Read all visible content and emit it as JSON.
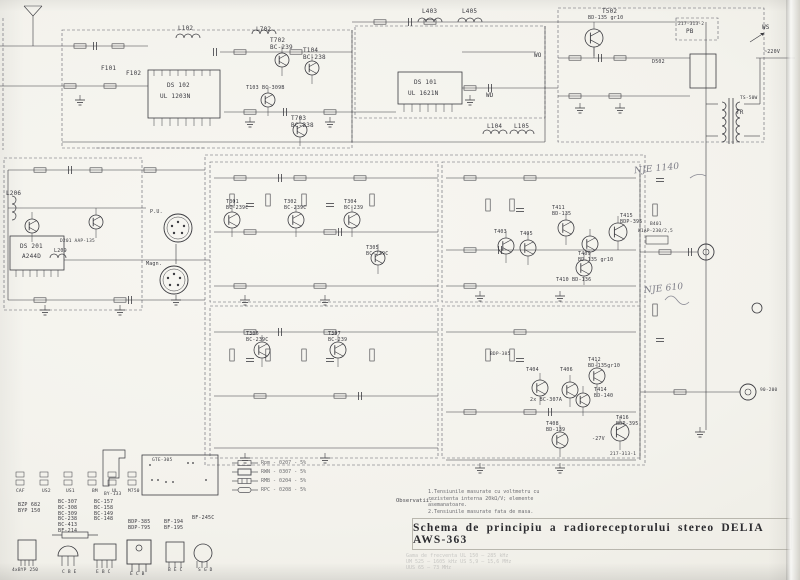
{
  "page": {
    "title": "Schema de principiu a radioreceptorului stereo DELIA AWS-363"
  },
  "colors": {
    "paper": "#f4f3ee",
    "ink": "#3b3b40",
    "dash": "#55555a",
    "pencil": "#7c7c86"
  },
  "notes": {
    "heading": "Observatii:",
    "line1": "1.Tensiunile masurate cu voltmetru cu rezistenta interna 20kΩ/V; elemente asemanatoare.",
    "line2": "2.Tensiunile masurate fata de masa."
  },
  "legend": {
    "items": [
      "Rpm - 0207 - 5%",
      "RWN - 0307 - 5%",
      "RMB - 0204 - 5%",
      "RPC - 0208 - 5%"
    ]
  },
  "freq": {
    "block": "Gama de frecventa\nUL 150 – 285 kHz\nUM 525 – 1605 kHz\nUS 5,9 – 15,6 MHz\nUUS 65 – 73 MHz"
  },
  "schematic": {
    "labels": [
      {
        "t": "L102",
        "x": 178,
        "y": 26
      },
      {
        "t": "F101",
        "x": 101,
        "y": 66
      },
      {
        "t": "F102",
        "x": 126,
        "y": 71
      },
      {
        "t": "DS 102",
        "x": 167,
        "y": 83
      },
      {
        "t": "UL 1203N",
        "x": 160,
        "y": 94
      },
      {
        "t": "L702",
        "x": 256,
        "y": 27
      },
      {
        "t": "T702\nBC-239",
        "x": 270,
        "y": 38
      },
      {
        "t": "T104\nBC-238",
        "x": 303,
        "y": 48
      },
      {
        "t": "T103 BC-309B",
        "x": 246,
        "y": 86,
        "fs": 5
      },
      {
        "t": "T703\nBC-238",
        "x": 291,
        "y": 116
      },
      {
        "t": "DS 101",
        "x": 414,
        "y": 80
      },
      {
        "t": "UL 1621N",
        "x": 408,
        "y": 91
      },
      {
        "t": "L403",
        "x": 422,
        "y": 9
      },
      {
        "t": "L405",
        "x": 462,
        "y": 9
      },
      {
        "t": "L104",
        "x": 487,
        "y": 124
      },
      {
        "t": "L105",
        "x": 514,
        "y": 124
      },
      {
        "t": "WO",
        "x": 534,
        "y": 53
      },
      {
        "t": "WD",
        "x": 486,
        "y": 93
      },
      {
        "t": "T502",
        "x": 602,
        "y": 9
      },
      {
        "t": "BD-135 gr10",
        "x": 588,
        "y": 16,
        "fs": 5
      },
      {
        "t": "217-313-2",
        "x": 678,
        "y": 22,
        "fs": 4.5
      },
      {
        "t": "PB",
        "x": 686,
        "y": 29
      },
      {
        "t": "D502",
        "x": 652,
        "y": 60,
        "fs": 5
      },
      {
        "t": "TR",
        "x": 736,
        "y": 110
      },
      {
        "t": "WS",
        "x": 762,
        "y": 25
      },
      {
        "t": "~220V",
        "x": 764,
        "y": 50,
        "fs": 5
      },
      {
        "t": "TS-50W",
        "x": 740,
        "y": 96,
        "fs": 4.5
      },
      {
        "t": "L206",
        "x": 6,
        "y": 191
      },
      {
        "t": "DS 201",
        "x": 20,
        "y": 244
      },
      {
        "t": "A244D",
        "x": 22,
        "y": 254
      },
      {
        "t": "D201 AAP-135",
        "x": 60,
        "y": 239,
        "fs": 4.5
      },
      {
        "t": "L209",
        "x": 54,
        "y": 249,
        "fs": 5
      },
      {
        "t": "P.U.",
        "x": 150,
        "y": 210,
        "fs": 5
      },
      {
        "t": "Magn.",
        "x": 146,
        "y": 262,
        "fs": 5
      },
      {
        "t": "T301\nBC-239C",
        "x": 226,
        "y": 200,
        "fs": 5
      },
      {
        "t": "T302\nBC-239C",
        "x": 284,
        "y": 200,
        "fs": 5
      },
      {
        "t": "T304\nBC-239",
        "x": 344,
        "y": 200,
        "fs": 5
      },
      {
        "t": "T305\nBC-239C",
        "x": 366,
        "y": 246,
        "fs": 5
      },
      {
        "t": "T306\nBC-239C",
        "x": 246,
        "y": 332,
        "fs": 5
      },
      {
        "t": "T307\nBC-239",
        "x": 328,
        "y": 332,
        "fs": 5
      },
      {
        "t": "T411\nBD-135",
        "x": 552,
        "y": 206,
        "fs": 5
      },
      {
        "t": "T415\nBDP-395",
        "x": 620,
        "y": 214,
        "fs": 5
      },
      {
        "t": "T403",
        "x": 494,
        "y": 230,
        "fs": 5
      },
      {
        "t": "T405",
        "x": 520,
        "y": 232,
        "fs": 5
      },
      {
        "t": "T409\nBD-135 gr10",
        "x": 578,
        "y": 252,
        "fs": 5
      },
      {
        "t": "T410 BD-136",
        "x": 556,
        "y": 278,
        "fs": 5
      },
      {
        "t": "B401",
        "x": 650,
        "y": 222,
        "fs": 4.5
      },
      {
        "t": "W1AP-230/2,5",
        "x": 638,
        "y": 229,
        "fs": 4.5
      },
      {
        "t": "NJE 1140",
        "x": 634,
        "y": 164,
        "cls": "hand",
        "n": "handwritten-annotation"
      },
      {
        "t": "NJE 610",
        "x": 644,
        "y": 284,
        "cls": "hand",
        "n": "handwritten-annotation"
      },
      {
        "t": "T404",
        "x": 526,
        "y": 368,
        "fs": 5
      },
      {
        "t": "T406",
        "x": 560,
        "y": 368,
        "fs": 5
      },
      {
        "t": "2x BC-307A",
        "x": 530,
        "y": 398,
        "fs": 5
      },
      {
        "t": "T412\nBD-135gr10",
        "x": 588,
        "y": 358,
        "fs": 5
      },
      {
        "t": "T414\nBD-140",
        "x": 594,
        "y": 388,
        "fs": 5
      },
      {
        "t": "T408\nBD-139",
        "x": 546,
        "y": 422,
        "fs": 5
      },
      {
        "t": "-27V",
        "x": 592,
        "y": 437,
        "fs": 5
      },
      {
        "t": "T416\nBDP-395",
        "x": 616,
        "y": 416,
        "fs": 5
      },
      {
        "t": "BDP-385",
        "x": 490,
        "y": 352,
        "fs": 4.5
      },
      {
        "t": "217-313-1",
        "x": 610,
        "y": 452,
        "fs": 4.5
      },
      {
        "t": "90-200",
        "x": 760,
        "y": 388,
        "fs": 4.5
      },
      {
        "t": "CAF",
        "x": 16,
        "y": 489,
        "fs": 4.5
      },
      {
        "t": "US2",
        "x": 42,
        "y": 489,
        "fs": 4.5
      },
      {
        "t": "US1",
        "x": 66,
        "y": 489,
        "fs": 4.5
      },
      {
        "t": "BM",
        "x": 92,
        "y": 489,
        "fs": 4.5
      },
      {
        "t": "UL",
        "x": 112,
        "y": 489,
        "fs": 4.5
      },
      {
        "t": "M750",
        "x": 128,
        "y": 489,
        "fs": 4.5
      },
      {
        "t": "BY-133",
        "x": 104,
        "y": 492,
        "fs": 4.5
      },
      {
        "t": "GTE-305",
        "x": 152,
        "y": 458,
        "fs": 4.5
      },
      {
        "t": "BZP 682\nBYP 150",
        "x": 18,
        "y": 503,
        "fs": 5
      },
      {
        "t": "BC-307\nBC-308\nBC-309\nBC-238\nBC-413\nBF-214",
        "x": 58,
        "y": 500,
        "fs": 5
      },
      {
        "t": "BC-157\nBC-158\nBC-149\nBC-148",
        "x": 94,
        "y": 500,
        "fs": 5
      },
      {
        "t": "BDP-385\nBDP-795",
        "x": 128,
        "y": 520,
        "fs": 5
      },
      {
        "t": "BF-194\nBF-195",
        "x": 164,
        "y": 520,
        "fs": 5
      },
      {
        "t": "BF-245C",
        "x": 192,
        "y": 516,
        "fs": 5
      },
      {
        "t": "C B E",
        "x": 62,
        "y": 570,
        "fs": 4.5
      },
      {
        "t": "E B C",
        "x": 96,
        "y": 570,
        "fs": 4.5
      },
      {
        "t": "E C B",
        "x": 130,
        "y": 572,
        "fs": 4.5
      },
      {
        "t": "B E C",
        "x": 168,
        "y": 568,
        "fs": 4.5
      },
      {
        "t": "S G D",
        "x": 198,
        "y": 568,
        "fs": 4.5
      },
      {
        "t": "4xBYP 250",
        "x": 12,
        "y": 568,
        "fs": 4.5
      }
    ]
  }
}
